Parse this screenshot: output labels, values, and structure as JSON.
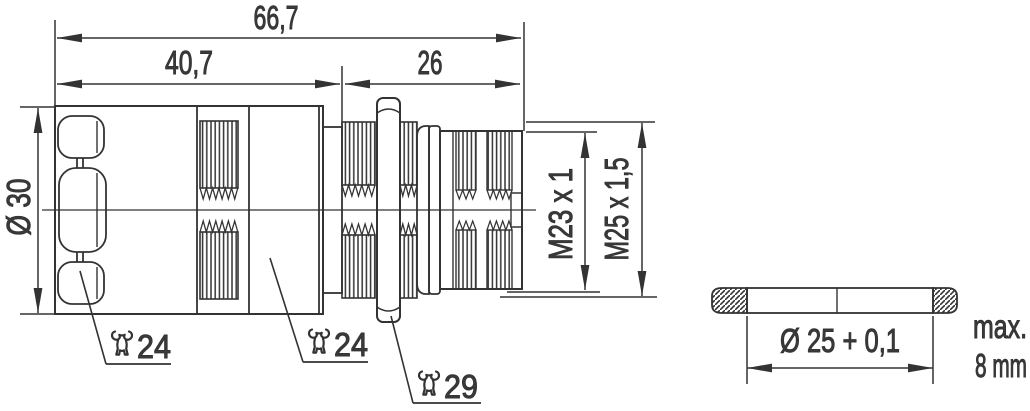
{
  "colors": {
    "line": "#333333",
    "background": "#ffffff"
  },
  "main_view": {
    "total_length": "66,7",
    "rear_length": "40,7",
    "front_length": "26",
    "grip_diameter": "Ø 30",
    "front_thread": "M23 x 1",
    "mounting_thread": "M25 x 1,5",
    "wrench_grip": "24",
    "wrench_body": "24",
    "wrench_nut": "29"
  },
  "panel_view": {
    "hole_diameter": "Ø 25 + 0,1",
    "max_label": "max.",
    "thickness": "8 mm"
  }
}
